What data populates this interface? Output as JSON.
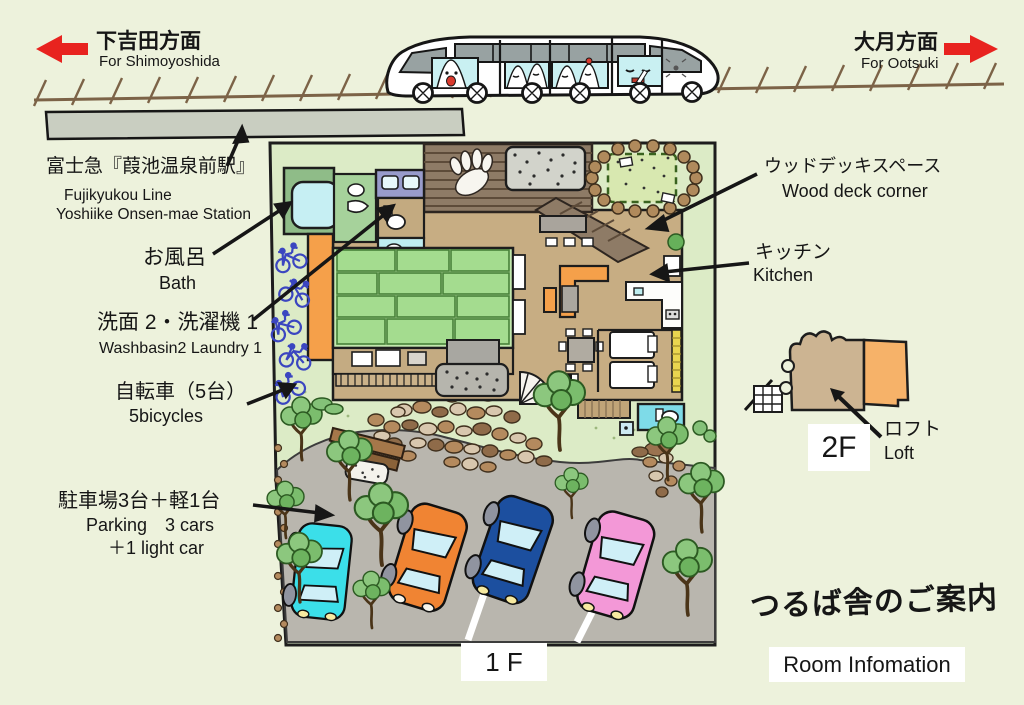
{
  "title": {
    "jp": "つるば舎のご案内",
    "en": "Room Infomation"
  },
  "directions": {
    "left": {
      "jp": "下吉田方面",
      "en": "For Shimoyoshida"
    },
    "right": {
      "jp": "大月方面",
      "en": "For Ootsuki"
    }
  },
  "station": {
    "jp": "富士急『葭池温泉前駅』",
    "en_line1": "Fujikyukou Line",
    "en_line2": "Yoshiike Onsen-mae Station"
  },
  "features": {
    "bath": {
      "jp": "お風呂",
      "en": "Bath"
    },
    "washbasin": {
      "jp": "洗面 2・洗濯機 1",
      "en": "Washbasin2 Laundry 1"
    },
    "bicycles": {
      "jp": "自転車（5台）",
      "en": "5bicycles"
    },
    "parking": {
      "jp": "駐車場3台＋軽1台",
      "en_line1": "Parking　3 cars",
      "en_line2": "＋1 light car"
    },
    "wood_deck": {
      "jp": "ウッドデッキスペース",
      "en": "Wood deck corner"
    },
    "kitchen": {
      "jp": "キッチン",
      "en": "Kitchen"
    },
    "loft": {
      "jp": "ロフト",
      "en": "Loft"
    }
  },
  "floors": {
    "f1": "1 F",
    "f2": "2F"
  },
  "cars": [
    {
      "name": "light car",
      "color": "#3BDFE9"
    },
    {
      "name": "car",
      "color": "#F08433"
    },
    {
      "name": "car",
      "color": "#1C4F9F"
    },
    {
      "name": "car",
      "color": "#F398D7"
    }
  ],
  "colors": {
    "direction_arrow": "#E8231F",
    "background": "#EDF2DC",
    "lawn": "#DCEBC6",
    "driveway": "#B9B6AE",
    "wood_deck": "#8E7B66",
    "tatami": "#A4DC8F",
    "tan_floor": "#C7AD83",
    "bicycle_blue": "#3B46C0",
    "bath_green": "#8FBC88",
    "orange_furniture": "#F5A04A"
  },
  "counts": {
    "bicycles": 5,
    "parking_cars": 3,
    "parking_light_cars": 1
  }
}
